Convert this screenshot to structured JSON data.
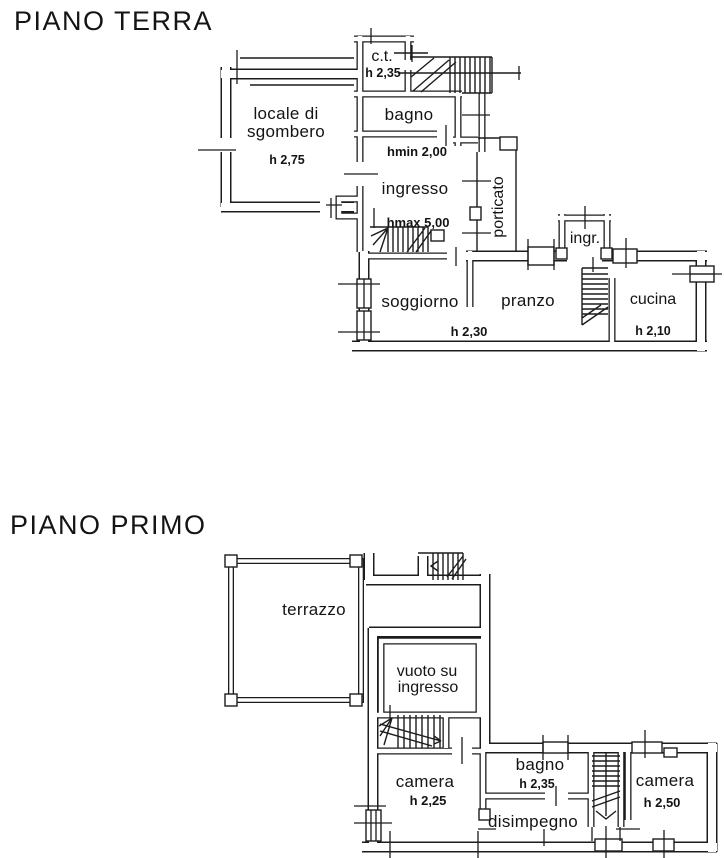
{
  "canvas": {
    "background": "#ffffff",
    "ink_color": "#1c1c1c"
  },
  "floors": {
    "ground": {
      "title": "PIANO TERRA",
      "rooms": {
        "locale_sgombero": {
          "label_line1": "locale di",
          "label_line2": "sgombero",
          "height": "h 2,75"
        },
        "centrale_termica": {
          "label": "c.t.",
          "height": "h 2,35"
        },
        "bagno": {
          "label": "bagno",
          "height_note": "hmin 2,00"
        },
        "ingresso": {
          "label": "ingresso",
          "height_note": "hmax 5,00"
        },
        "porticato": {
          "label": "porticato"
        },
        "ingresso_esterno": {
          "label": "ingr."
        },
        "soggiorno": {
          "label": "soggiorno"
        },
        "pranzo": {
          "label": "pranzo",
          "height": "h 2,30"
        },
        "cucina": {
          "label": "cucina",
          "height": "h 2,10"
        }
      }
    },
    "first": {
      "title": "PIANO PRIMO",
      "rooms": {
        "terrazzo": {
          "label": "terrazzo"
        },
        "vuoto_su_ingresso": {
          "label_line1": "vuoto su",
          "label_line2": "ingresso"
        },
        "camera_sx": {
          "label": "camera",
          "height": "h 2,25"
        },
        "bagno": {
          "label": "bagno",
          "height": "h 2,35"
        },
        "disimpegno": {
          "label": "disimpegno"
        },
        "camera_dx": {
          "label": "camera",
          "height": "h 2,50"
        }
      }
    }
  }
}
